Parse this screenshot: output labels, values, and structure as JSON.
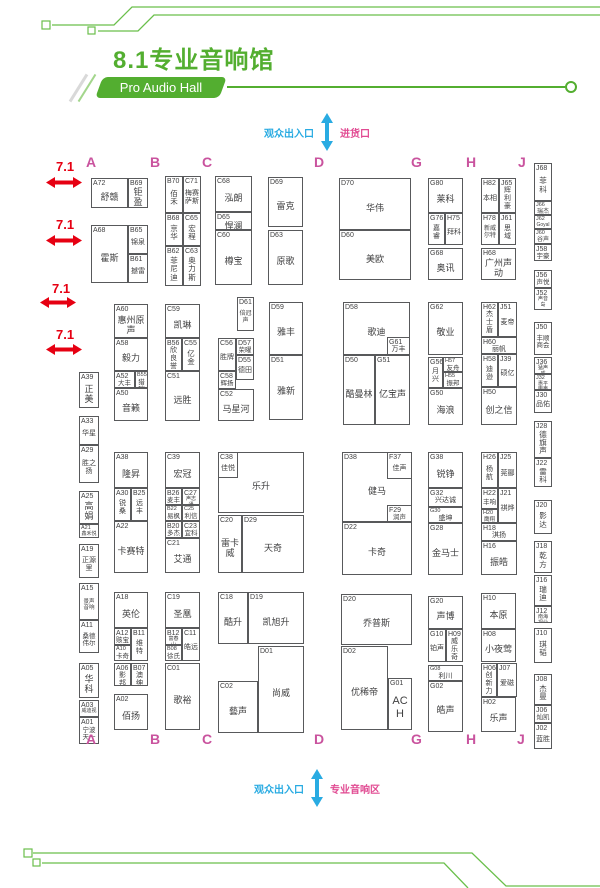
{
  "header": {
    "title": "8.1专业音响馆",
    "subtitle": "Pro Audio Hall"
  },
  "gates": {
    "top": {
      "left": "观众出入口",
      "right": "进货口"
    },
    "bottom": {
      "left": "观众出入口",
      "right": "专业音响区"
    }
  },
  "colors": {
    "green": "#53ae30",
    "magenta_letters": "#c9539e",
    "pink_labels": "#e14a92",
    "red_aisle": "#e60012",
    "blue_gate": "#29abe2",
    "booth_border": "#58595b"
  },
  "hall_letters": [
    {
      "t": "A",
      "x": 86,
      "y": 155,
      "pos": "top"
    },
    {
      "t": "B",
      "x": 150,
      "y": 155,
      "pos": "top"
    },
    {
      "t": "C",
      "x": 202,
      "y": 155,
      "pos": "top"
    },
    {
      "t": "D",
      "x": 314,
      "y": 155,
      "pos": "top"
    },
    {
      "t": "G",
      "x": 411,
      "y": 155,
      "pos": "top"
    },
    {
      "t": "H",
      "x": 466,
      "y": 155,
      "pos": "top"
    },
    {
      "t": "J",
      "x": 518,
      "y": 155,
      "pos": "top"
    },
    {
      "t": "A",
      "x": 86,
      "y": 732,
      "pos": "bottom"
    },
    {
      "t": "B",
      "x": 150,
      "y": 732,
      "pos": "bottom"
    },
    {
      "t": "C",
      "x": 202,
      "y": 732,
      "pos": "bottom"
    },
    {
      "t": "D",
      "x": 314,
      "y": 732,
      "pos": "bottom"
    },
    {
      "t": "G",
      "x": 411,
      "y": 732,
      "pos": "bottom"
    },
    {
      "t": "H",
      "x": 466,
      "y": 732,
      "pos": "bottom"
    },
    {
      "t": "J",
      "x": 517,
      "y": 732,
      "pos": "bottom"
    }
  ],
  "aisle_markers": [
    {
      "label": "7.1",
      "x": 56,
      "y": 160,
      "ax": 46,
      "ay": 177
    },
    {
      "label": "7.1",
      "x": 56,
      "y": 218,
      "ax": 46,
      "ay": 235
    },
    {
      "label": "7.1",
      "x": 52,
      "y": 282,
      "ax": 40,
      "ay": 297
    },
    {
      "label": "7.1",
      "x": 56,
      "y": 328,
      "ax": 46,
      "ay": 344
    }
  ],
  "booths": [
    {
      "id": "A72",
      "n": "舒赣",
      "x": 91,
      "y": 178,
      "w": 37,
      "h": 30
    },
    {
      "id": "B69",
      "n": "钜盈",
      "x": 128,
      "y": 178,
      "w": 20,
      "h": 30
    },
    {
      "id": "A68",
      "n": "霍斯",
      "x": 91,
      "y": 225,
      "w": 37,
      "h": 58
    },
    {
      "id": "B65",
      "n": "锦泉",
      "x": 128,
      "y": 225,
      "w": 20,
      "h": 29,
      "fs": 7
    },
    {
      "id": "B61",
      "n": "撼雷",
      "x": 128,
      "y": 254,
      "w": 20,
      "h": 29,
      "fs": 7
    },
    {
      "id": "B70",
      "n": "佰禾",
      "x": 165,
      "y": 176,
      "w": 18,
      "h": 37
    },
    {
      "id": "C71",
      "n": "梅赛萨斯",
      "x": 183,
      "y": 176,
      "w": 18,
      "h": 37,
      "fs": 7
    },
    {
      "id": "B68",
      "n": "京华",
      "x": 165,
      "y": 213,
      "w": 18,
      "h": 33
    },
    {
      "id": "C65",
      "n": "宏程",
      "x": 183,
      "y": 213,
      "w": 18,
      "h": 33
    },
    {
      "id": "B62",
      "n": "菲尼迪",
      "x": 165,
      "y": 246,
      "w": 18,
      "h": 40
    },
    {
      "id": "C63",
      "n": "奥力斯",
      "x": 183,
      "y": 246,
      "w": 18,
      "h": 40
    },
    {
      "id": "C68",
      "n": "泓朗",
      "x": 215,
      "y": 176,
      "w": 37,
      "h": 36
    },
    {
      "id": "D65",
      "n": "悍澜",
      "x": 215,
      "y": 212,
      "w": 37,
      "h": 18
    },
    {
      "id": "C60",
      "n": "樽宝",
      "x": 215,
      "y": 230,
      "w": 37,
      "h": 55
    },
    {
      "id": "D69",
      "n": "雷克",
      "x": 268,
      "y": 177,
      "w": 35,
      "h": 50
    },
    {
      "id": "D63",
      "n": "原歌",
      "x": 268,
      "y": 230,
      "w": 35,
      "h": 55
    },
    {
      "id": "D70",
      "n": "华伟",
      "x": 339,
      "y": 178,
      "w": 72,
      "h": 52
    },
    {
      "id": "D60",
      "n": "美欧",
      "x": 339,
      "y": 230,
      "w": 72,
      "h": 50
    },
    {
      "id": "G80",
      "n": "莱科",
      "x": 428,
      "y": 178,
      "w": 35,
      "h": 35
    },
    {
      "id": "G76",
      "n": "嘉睿",
      "x": 428,
      "y": 213,
      "w": 17,
      "h": 32,
      "fs": 7
    },
    {
      "id": "H75",
      "n": "拜科",
      "x": 445,
      "y": 213,
      "w": 18,
      "h": 32,
      "fs": 7
    },
    {
      "id": "G68",
      "n": "奥讯",
      "x": 428,
      "y": 248,
      "w": 35,
      "h": 32
    },
    {
      "id": "H82",
      "n": "本相",
      "x": 481,
      "y": 178,
      "w": 18,
      "h": 35,
      "fs": 7
    },
    {
      "id": "J65",
      "n": "辉利豪",
      "x": 499,
      "y": 178,
      "w": 17,
      "h": 35,
      "fs": 7
    },
    {
      "id": "H78",
      "n": "新威尔特",
      "x": 481,
      "y": 213,
      "w": 18,
      "h": 32,
      "fs": 6
    },
    {
      "id": "J61",
      "n": "思域",
      "x": 499,
      "y": 213,
      "w": 17,
      "h": 32,
      "fs": 7
    },
    {
      "id": "H68",
      "n": "广州声动",
      "x": 481,
      "y": 248,
      "w": 35,
      "h": 32
    },
    {
      "id": "J68",
      "n": "菲科",
      "x": 534,
      "y": 163,
      "w": 18,
      "h": 38
    },
    {
      "id": "J66",
      "n": "瑞杰",
      "x": 534,
      "y": 201,
      "w": 18,
      "h": 14,
      "fs": 6
    },
    {
      "id": "J62",
      "n": "Goyal",
      "x": 534,
      "y": 215,
      "w": 18,
      "h": 14,
      "fs": 5
    },
    {
      "id": "J60",
      "n": "谷声",
      "x": 534,
      "y": 229,
      "w": 18,
      "h": 15,
      "fs": 6
    },
    {
      "id": "J58",
      "n": "宇豪",
      "x": 534,
      "y": 244,
      "w": 18,
      "h": 17,
      "fs": 6.5
    },
    {
      "id": "J56",
      "n": "声悦",
      "x": 534,
      "y": 270,
      "w": 18,
      "h": 18,
      "fs": 6.5
    },
    {
      "id": "J52",
      "n": "声音岛",
      "x": 534,
      "y": 288,
      "w": 18,
      "h": 22,
      "fs": 5
    },
    {
      "id": "J50",
      "n": "丰顺商会",
      "x": 534,
      "y": 322,
      "w": 18,
      "h": 33,
      "fs": 6.5
    },
    {
      "id": "J36",
      "n": "猛声威",
      "x": 534,
      "y": 357,
      "w": 18,
      "h": 17,
      "fs": 5
    },
    {
      "id": "J32",
      "n": "惠平电声",
      "x": 534,
      "y": 374,
      "w": 18,
      "h": 16,
      "fs": 5
    },
    {
      "id": "J30",
      "n": "品佑",
      "x": 534,
      "y": 390,
      "w": 18,
      "h": 23,
      "fs": 7
    },
    {
      "id": "J28",
      "n": "德旗声",
      "x": 534,
      "y": 421,
      "w": 18,
      "h": 37
    },
    {
      "id": "J22",
      "n": "雷科",
      "x": 534,
      "y": 458,
      "w": 18,
      "h": 29
    },
    {
      "id": "J20",
      "n": "影达",
      "x": 534,
      "y": 500,
      "w": 18,
      "h": 34
    },
    {
      "id": "J18",
      "n": "乾方",
      "x": 534,
      "y": 541,
      "w": 18,
      "h": 32
    },
    {
      "id": "J16",
      "n": "瑞迪",
      "x": 534,
      "y": 575,
      "w": 18,
      "h": 31
    },
    {
      "id": "J12",
      "n": "南海视业",
      "x": 534,
      "y": 606,
      "w": 18,
      "h": 17,
      "fs": 5
    },
    {
      "id": "J10",
      "n": "琪韬",
      "x": 534,
      "y": 628,
      "w": 18,
      "h": 35
    },
    {
      "id": "J08",
      "n": "杰曼",
      "x": 534,
      "y": 674,
      "w": 18,
      "h": 31
    },
    {
      "id": "J06",
      "n": "灿凯",
      "x": 534,
      "y": 705,
      "w": 18,
      "h": 18,
      "fs": 6.5
    },
    {
      "id": "J02",
      "n": "蓝胜",
      "x": 534,
      "y": 723,
      "w": 18,
      "h": 26,
      "fs": 7
    },
    {
      "id": "A39",
      "n": "正美",
      "x": 79,
      "y": 372,
      "w": 20,
      "h": 36
    },
    {
      "id": "A33",
      "n": "华星",
      "x": 79,
      "y": 416,
      "w": 20,
      "h": 29,
      "fs": 7
    },
    {
      "id": "A29",
      "n": "胜之扬",
      "x": 79,
      "y": 445,
      "w": 20,
      "h": 38,
      "fs": 7
    },
    {
      "id": "A25",
      "n": "高娟",
      "x": 79,
      "y": 491,
      "w": 20,
      "h": 33
    },
    {
      "id": "A21",
      "n": "鑫禾悦",
      "x": 79,
      "y": 524,
      "w": 20,
      "h": 14,
      "fs": 5
    },
    {
      "id": "A19",
      "n": "正源里",
      "x": 79,
      "y": 544,
      "w": 20,
      "h": 34,
      "fs": 7
    },
    {
      "id": "A15",
      "n": "景声音响",
      "x": 79,
      "y": 583,
      "w": 20,
      "h": 37,
      "fs": 5.5
    },
    {
      "id": "A11",
      "n": "桑德伟尔",
      "x": 79,
      "y": 620,
      "w": 20,
      "h": 33,
      "fs": 6.5
    },
    {
      "id": "A05",
      "n": "华科",
      "x": 79,
      "y": 663,
      "w": 20,
      "h": 35
    },
    {
      "id": "A03",
      "n": "威迪视",
      "x": 79,
      "y": 700,
      "w": 20,
      "h": 17,
      "fs": 5
    },
    {
      "id": "A01",
      "n": "宁波天一",
      "x": 79,
      "y": 717,
      "w": 20,
      "h": 27,
      "fs": 6.5
    },
    {
      "id": "A60",
      "n": "惠州原声",
      "x": 114,
      "y": 304,
      "w": 34,
      "h": 34
    },
    {
      "id": "A58",
      "n": "毅力",
      "x": 114,
      "y": 338,
      "w": 34,
      "h": 33
    },
    {
      "id": "A52",
      "n": "大丰",
      "x": 114,
      "y": 371,
      "w": 21,
      "h": 17,
      "fs": 6.5
    },
    {
      "id": "B55",
      "n": "猎瑞",
      "x": 135,
      "y": 371,
      "w": 13,
      "h": 17,
      "fs": 6.5
    },
    {
      "id": "A50",
      "n": "音籁",
      "x": 114,
      "y": 388,
      "w": 34,
      "h": 33
    },
    {
      "id": "C59",
      "n": "凯琳",
      "x": 165,
      "y": 304,
      "w": 35,
      "h": 34
    },
    {
      "id": "B56",
      "n": "欣良誉",
      "x": 165,
      "y": 338,
      "w": 17,
      "h": 33,
      "fs": 7
    },
    {
      "id": "C55",
      "n": "亿金",
      "x": 182,
      "y": 338,
      "w": 18,
      "h": 33
    },
    {
      "id": "C51",
      "n": "远胜",
      "x": 165,
      "y": 371,
      "w": 35,
      "h": 50
    },
    {
      "id": "D61",
      "n": "倍冠声",
      "x": 237,
      "y": 297,
      "w": 17,
      "h": 34,
      "fs": 6
    },
    {
      "id": "C56",
      "n": "胜牌",
      "x": 218,
      "y": 338,
      "w": 18,
      "h": 33,
      "fs": 7
    },
    {
      "id": "D57",
      "n": "荣曜",
      "x": 236,
      "y": 338,
      "w": 18,
      "h": 17,
      "fs": 6.5
    },
    {
      "id": "D55",
      "n": "德田",
      "x": 236,
      "y": 355,
      "w": 18,
      "h": 25,
      "fs": 7
    },
    {
      "id": "C58",
      "n": "辉扬",
      "x": 218,
      "y": 371,
      "w": 18,
      "h": 18,
      "fs": 6.5
    },
    {
      "id": "C52",
      "n": "马星河",
      "x": 218,
      "y": 389,
      "w": 36,
      "h": 32
    },
    {
      "id": "D59",
      "n": "雅丰",
      "x": 269,
      "y": 302,
      "w": 34,
      "h": 53
    },
    {
      "id": "D51",
      "n": "雅新",
      "x": 269,
      "y": 355,
      "w": 34,
      "h": 65
    },
    {
      "id": "D58",
      "n": "歌迪",
      "x": 343,
      "y": 302,
      "w": 67,
      "h": 53
    },
    {
      "id": "G61",
      "n": "万丰",
      "x": 387,
      "y": 337,
      "w": 23,
      "h": 18,
      "fs": 7
    },
    {
      "id": "D50",
      "n": "酷曼林",
      "x": 343,
      "y": 355,
      "w": 32,
      "h": 70
    },
    {
      "id": "G51",
      "n": "亿宝声",
      "x": 375,
      "y": 355,
      "w": 35,
      "h": 70
    },
    {
      "id": "G62",
      "n": "敬业",
      "x": 428,
      "y": 302,
      "w": 35,
      "h": 53
    },
    {
      "id": "G56",
      "n": "月兴",
      "x": 428,
      "y": 357,
      "w": 15,
      "h": 31,
      "fs": 7
    },
    {
      "id": "H57",
      "n": "友舟",
      "x": 443,
      "y": 357,
      "w": 20,
      "h": 15,
      "fs": 6.5
    },
    {
      "id": "H55",
      "n": "振邦",
      "x": 443,
      "y": 372,
      "w": 20,
      "h": 16,
      "fs": 6.5
    },
    {
      "id": "G50",
      "n": "海浪",
      "x": 428,
      "y": 388,
      "w": 35,
      "h": 37
    },
    {
      "id": "H62",
      "n": "杰士盾",
      "x": 481,
      "y": 302,
      "w": 17,
      "h": 35,
      "fs": 7
    },
    {
      "id": "J51",
      "n": "麦帝",
      "x": 498,
      "y": 302,
      "w": 19,
      "h": 35,
      "fs": 7
    },
    {
      "id": "H60",
      "n": "丽帆",
      "x": 481,
      "y": 337,
      "w": 36,
      "h": 17,
      "fs": 7
    },
    {
      "id": "H58",
      "n": "迪逊",
      "x": 481,
      "y": 354,
      "w": 17,
      "h": 33,
      "fs": 7
    },
    {
      "id": "J39",
      "n": "硕亿",
      "x": 498,
      "y": 354,
      "w": 19,
      "h": 33,
      "fs": 7
    },
    {
      "id": "H50",
      "n": "创之信",
      "x": 481,
      "y": 387,
      "w": 36,
      "h": 38
    },
    {
      "id": "A38",
      "n": "隆昇",
      "x": 114,
      "y": 452,
      "w": 34,
      "h": 36
    },
    {
      "id": "A30",
      "n": "锐桑",
      "x": 114,
      "y": 488,
      "w": 17,
      "h": 33,
      "fs": 7
    },
    {
      "id": "B25",
      "n": "远丰",
      "x": 131,
      "y": 488,
      "w": 17,
      "h": 33,
      "fs": 7
    },
    {
      "id": "A22",
      "n": "卡赛特",
      "x": 114,
      "y": 521,
      "w": 34,
      "h": 52
    },
    {
      "id": "C39",
      "n": "宏冠",
      "x": 165,
      "y": 452,
      "w": 35,
      "h": 36
    },
    {
      "id": "B26",
      "n": "麦丰",
      "x": 165,
      "y": 488,
      "w": 17,
      "h": 17,
      "fs": 6.5
    },
    {
      "id": "C27",
      "n": "声志通",
      "x": 182,
      "y": 488,
      "w": 18,
      "h": 17,
      "fs": 5
    },
    {
      "id": "B22",
      "n": "易枫",
      "x": 165,
      "y": 505,
      "w": 17,
      "h": 16,
      "fs": 6.5
    },
    {
      "id": "C25",
      "n": "利信",
      "x": 182,
      "y": 505,
      "w": 18,
      "h": 16,
      "fs": 6.5
    },
    {
      "id": "B20",
      "n": "多杰",
      "x": 165,
      "y": 521,
      "w": 17,
      "h": 17,
      "fs": 6.5
    },
    {
      "id": "C23",
      "n": "宜科",
      "x": 182,
      "y": 521,
      "w": 18,
      "h": 17,
      "fs": 6.5
    },
    {
      "id": "C21",
      "n": "艾通",
      "x": 165,
      "y": 538,
      "w": 35,
      "h": 35
    },
    {
      "id": "D39",
      "n": "乐升",
      "x": 218,
      "y": 452,
      "w": 86,
      "h": 61
    },
    {
      "id": "C38",
      "n": "佳悦",
      "x": 218,
      "y": 452,
      "w": 20,
      "h": 26,
      "fs": 7
    },
    {
      "id": "C20",
      "n": "雷卡威",
      "x": 218,
      "y": 515,
      "w": 24,
      "h": 58
    },
    {
      "id": "D29",
      "n": "天奇",
      "x": 242,
      "y": 515,
      "w": 62,
      "h": 58
    },
    {
      "id": "D38",
      "n": "健马",
      "x": 342,
      "y": 452,
      "w": 70,
      "h": 70
    },
    {
      "id": "F37",
      "n": "佳声",
      "x": 387,
      "y": 452,
      "w": 25,
      "h": 27,
      "fs": 7
    },
    {
      "id": "F29",
      "n": "润声",
      "x": 387,
      "y": 505,
      "w": 25,
      "h": 17,
      "fs": 6.5
    },
    {
      "id": "D22",
      "n": "卡奇",
      "x": 342,
      "y": 522,
      "w": 70,
      "h": 53
    },
    {
      "id": "G38",
      "n": "锐铮",
      "x": 428,
      "y": 452,
      "w": 35,
      "h": 36
    },
    {
      "id": "G32",
      "n": "兴达诚",
      "x": 428,
      "y": 488,
      "w": 35,
      "h": 19,
      "fs": 7
    },
    {
      "id": "G30",
      "n": "盛坤",
      "x": 428,
      "y": 507,
      "w": 35,
      "h": 16,
      "fs": 7
    },
    {
      "id": "G28",
      "n": "金马士",
      "x": 428,
      "y": 523,
      "w": 35,
      "h": 52
    },
    {
      "id": "H26",
      "n": "杨航",
      "x": 481,
      "y": 452,
      "w": 17,
      "h": 36,
      "fs": 7
    },
    {
      "id": "J25",
      "n": "莞郦",
      "x": 498,
      "y": 452,
      "w": 19,
      "h": 36,
      "fs": 7
    },
    {
      "id": "H22",
      "n": "丰响",
      "x": 481,
      "y": 488,
      "w": 17,
      "h": 21,
      "fs": 6.5
    },
    {
      "id": "J21",
      "n": "祺烨",
      "x": 498,
      "y": 488,
      "w": 19,
      "h": 35,
      "fs": 7
    },
    {
      "id": "H20",
      "n": "鹰翔",
      "x": 481,
      "y": 509,
      "w": 17,
      "h": 14,
      "fs": 5.5
    },
    {
      "id": "H18",
      "n": "淇扬",
      "x": 481,
      "y": 523,
      "w": 36,
      "h": 18,
      "fs": 7
    },
    {
      "id": "H16",
      "n": "振皓",
      "x": 481,
      "y": 541,
      "w": 36,
      "h": 34
    },
    {
      "id": "A18",
      "n": "英伦",
      "x": 114,
      "y": 592,
      "w": 34,
      "h": 36
    },
    {
      "id": "A12",
      "n": "赅宝",
      "x": 114,
      "y": 628,
      "w": 17,
      "h": 17,
      "fs": 6.5
    },
    {
      "id": "B11",
      "n": "维特",
      "x": 131,
      "y": 628,
      "w": 17,
      "h": 33,
      "fs": 7
    },
    {
      "id": "A10",
      "n": "卡奇",
      "x": 114,
      "y": 645,
      "w": 17,
      "h": 16,
      "fs": 6.5
    },
    {
      "id": "A06",
      "n": "影邦",
      "x": 114,
      "y": 663,
      "w": 17,
      "h": 23,
      "fs": 7
    },
    {
      "id": "B07",
      "n": "澳绅",
      "x": 131,
      "y": 663,
      "w": 17,
      "h": 23,
      "fs": 7
    },
    {
      "id": "A02",
      "n": "佰扬",
      "x": 114,
      "y": 694,
      "w": 34,
      "h": 36
    },
    {
      "id": "C19",
      "n": "圣凰",
      "x": 165,
      "y": 592,
      "w": 35,
      "h": 36
    },
    {
      "id": "B12",
      "n": "富春山",
      "x": 165,
      "y": 628,
      "w": 17,
      "h": 17,
      "fs": 5
    },
    {
      "id": "C11",
      "n": "皓远",
      "x": 182,
      "y": 628,
      "w": 18,
      "h": 33,
      "fs": 7
    },
    {
      "id": "B08",
      "n": "徐氏",
      "x": 165,
      "y": 645,
      "w": 17,
      "h": 16,
      "fs": 6.5
    },
    {
      "id": "C01",
      "n": "歌裕",
      "x": 165,
      "y": 663,
      "w": 35,
      "h": 67
    },
    {
      "id": "C18",
      "n": "酷升",
      "x": 218,
      "y": 592,
      "w": 30,
      "h": 52
    },
    {
      "id": "D19",
      "n": "凯旭升",
      "x": 248,
      "y": 592,
      "w": 56,
      "h": 52
    },
    {
      "id": "D01",
      "n": "尚威",
      "x": 258,
      "y": 646,
      "w": 46,
      "h": 87
    },
    {
      "id": "C02",
      "n": "藝声",
      "x": 218,
      "y": 681,
      "w": 40,
      "h": 52
    },
    {
      "id": "D20",
      "n": "乔普斯",
      "x": 341,
      "y": 594,
      "w": 71,
      "h": 51
    },
    {
      "id": "D02",
      "n": "优稀帝",
      "x": 341,
      "y": 646,
      "w": 47,
      "h": 84
    },
    {
      "id": "G01",
      "n": "ACH",
      "x": 388,
      "y": 678,
      "w": 24,
      "h": 52,
      "fs": 11
    },
    {
      "id": "G20",
      "n": "声博",
      "x": 428,
      "y": 596,
      "w": 35,
      "h": 33
    },
    {
      "id": "G10",
      "n": "铂声",
      "x": 428,
      "y": 629,
      "w": 18,
      "h": 33,
      "fs": 7
    },
    {
      "id": "H09",
      "n": "威乐奇",
      "x": 446,
      "y": 629,
      "w": 17,
      "h": 33,
      "fs": 7
    },
    {
      "id": "G08",
      "n": "利川",
      "x": 428,
      "y": 665,
      "w": 35,
      "h": 16,
      "fs": 7
    },
    {
      "id": "G02",
      "n": "皓声",
      "x": 428,
      "y": 681,
      "w": 35,
      "h": 51
    },
    {
      "id": "H10",
      "n": "本原",
      "x": 481,
      "y": 593,
      "w": 35,
      "h": 36
    },
    {
      "id": "H08",
      "n": "小夜莺",
      "x": 481,
      "y": 629,
      "w": 35,
      "h": 33
    },
    {
      "id": "H06",
      "n": "创新力",
      "x": 481,
      "y": 663,
      "w": 16,
      "h": 34,
      "fs": 7
    },
    {
      "id": "J07",
      "n": "爱磁",
      "x": 497,
      "y": 663,
      "w": 20,
      "h": 34,
      "fs": 7
    },
    {
      "id": "H02",
      "n": "乐声",
      "x": 481,
      "y": 697,
      "w": 35,
      "h": 35
    }
  ]
}
